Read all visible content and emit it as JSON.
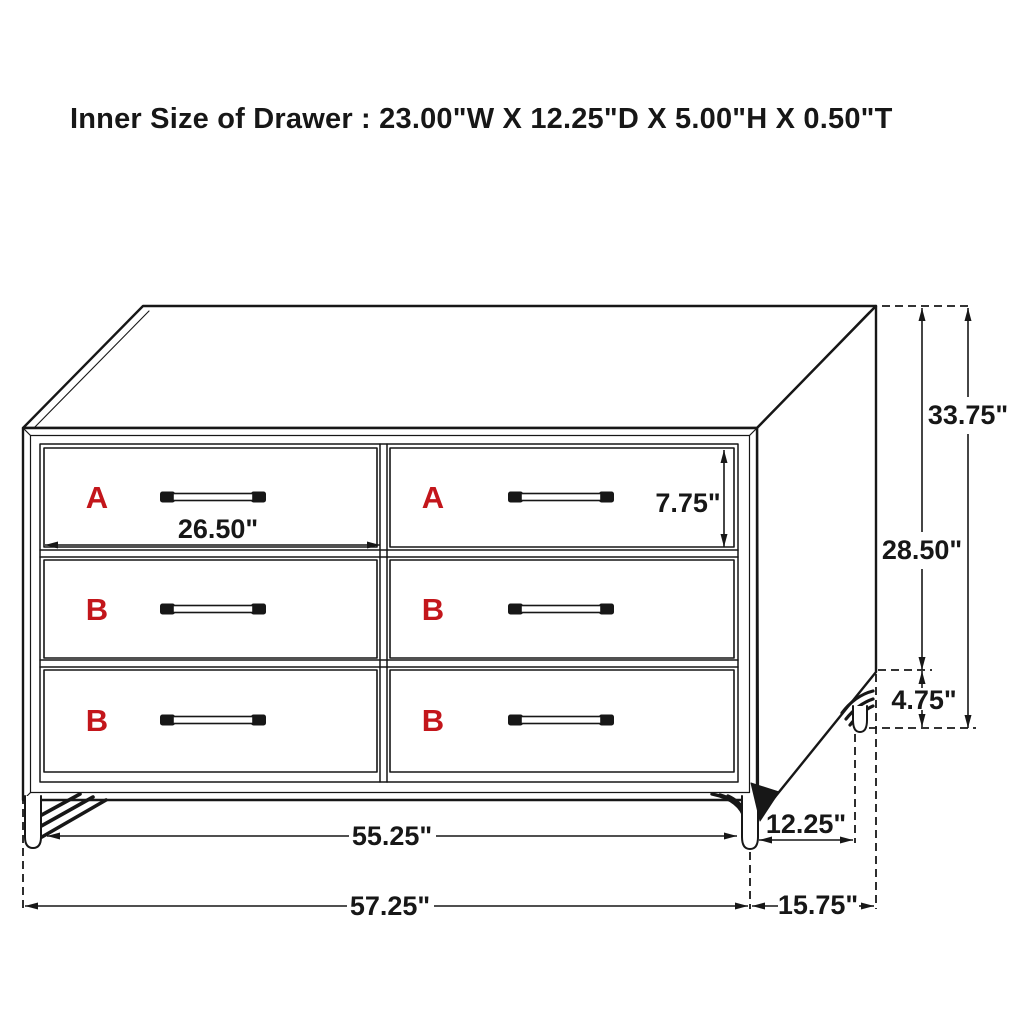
{
  "title": "Inner Size of Drawer : 23.00\"W X 12.25\"D X 5.00\"H X 0.50\"T",
  "figure": {
    "type": "furniture dimension diagram",
    "item": "six-drawer dresser with hairpin legs"
  },
  "drawers": [
    {
      "label": "A",
      "row": 1,
      "col": "left"
    },
    {
      "label": "A",
      "row": 1,
      "col": "right"
    },
    {
      "label": "B",
      "row": 2,
      "col": "left"
    },
    {
      "label": "B",
      "row": 2,
      "col": "right"
    },
    {
      "label": "B",
      "row": 3,
      "col": "left"
    },
    {
      "label": "B",
      "row": 3,
      "col": "right"
    }
  ],
  "dimensions": {
    "drawer_front_width": "26.50\"",
    "drawer_front_height": "7.75\"",
    "overall_height": "33.75\"",
    "case_height": "28.50\"",
    "leg_height": "4.75\"",
    "front_leg_spacing": "55.25\"",
    "side_leg_spacing": "12.25\"",
    "overall_width": "57.25\"",
    "overall_depth": "15.75\""
  },
  "colors": {
    "line": "#171717",
    "drawer_label_red": "#c3161b",
    "background": "#ffffff"
  }
}
